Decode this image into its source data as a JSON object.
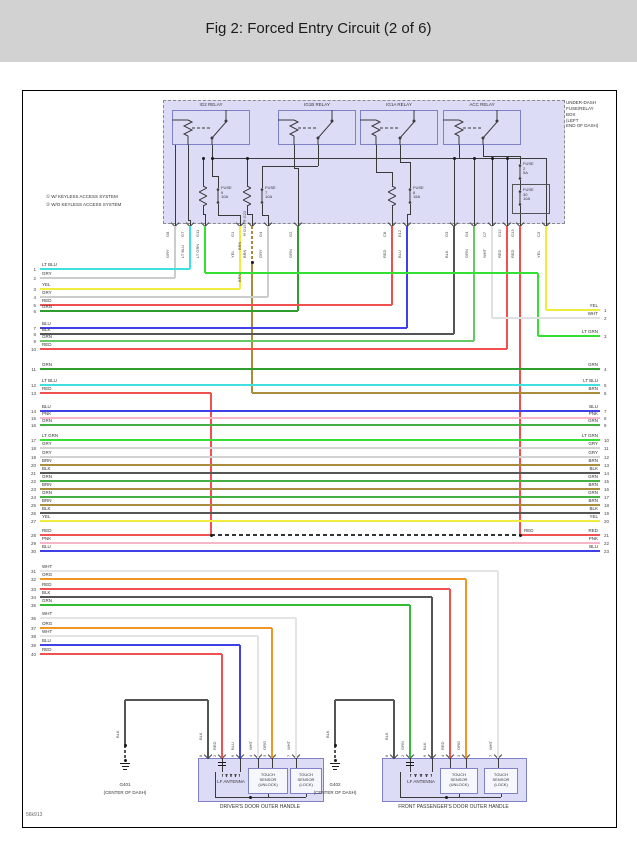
{
  "title": "Fig 2: Forced Entry Circuit (2 of 6)",
  "footer_id": "56k913",
  "palette": {
    "header": "#d2d2d2",
    "box_fill": "#dcdcf7",
    "box_border": "#8a8a8a",
    "line": "#3a3a3a"
  },
  "box_label_lines": [
    "UNDER-DASH",
    "FUSE/RELAY",
    "BOX",
    "(LEFT",
    "END OF DASH)"
  ],
  "notes": [
    "① W/ KEYLESS ACCESS SYSTEM",
    "② W/O KEYLESS ACCESS SYSTEM"
  ],
  "relays": [
    {
      "label": "IG2 RELAY",
      "x": 172
    },
    {
      "label": "IG1B RELAY",
      "x": 278
    },
    {
      "label": "IG1A RELAY",
      "x": 360
    },
    {
      "label": "ACC RELAY",
      "x": 443
    }
  ],
  "fuses": [
    {
      "x": 218,
      "y": 188,
      "lines": [
        "FUSE",
        "9",
        "10A"
      ],
      "res_x": 203
    },
    {
      "x": 262,
      "y": 188,
      "lines": [
        "FUSE",
        "7",
        "10A"
      ],
      "res_x": 247
    },
    {
      "x": 410,
      "y": 188,
      "lines": [
        "FUSE",
        "8",
        "15A"
      ],
      "res_x": 392
    },
    {
      "x": 520,
      "y": 164,
      "lines": [
        "FUSE",
        "2",
        "5A"
      ]
    },
    {
      "x": 520,
      "y": 190,
      "lines": [
        "FUSE",
        "30",
        "10A"
      ],
      "boxed": true
    }
  ],
  "fuse30_box": [
    512,
    184,
    36,
    28
  ],
  "top_pins": [
    {
      "x": 175,
      "id": "G8",
      "c": "GRY"
    },
    {
      "x": 190,
      "id": "G7",
      "c": "LT BLU"
    },
    {
      "x": 205,
      "id": "G11",
      "c": "LT GRN"
    },
    {
      "x": 240,
      "id": "G1",
      "c": "YEL"
    },
    {
      "x": 252,
      "id": "①G15 ②G22",
      "c": "BRN"
    },
    {
      "x": 268,
      "id": "G4",
      "c": "GRY"
    },
    {
      "x": 298,
      "id": "G2",
      "c": "GRN"
    },
    {
      "x": 392,
      "id": "C8",
      "c": "RED"
    },
    {
      "x": 407,
      "id": "E12",
      "c": "BLU"
    },
    {
      "x": 454,
      "id": "G3",
      "c": "BLK"
    },
    {
      "x": 474,
      "id": "G4",
      "c": "GRN"
    },
    {
      "x": 492,
      "id": "C7",
      "c": "WHT"
    },
    {
      "x": 507,
      "id": "G12",
      "c": "RED"
    },
    {
      "x": 520,
      "id": "G13",
      "c": "RED"
    },
    {
      "x": 546,
      "id": "C3",
      "c": "YEL"
    }
  ],
  "left_rows": [
    {
      "n": 1,
      "c": "LT BLU",
      "y": 269,
      "x1": 40,
      "x2": 190,
      "hex": "#40e0e0"
    },
    {
      "n": 2,
      "c": "GRY",
      "y": 278,
      "x1": 40,
      "x2": 175,
      "hex": "#cccccc"
    },
    {
      "n": 3,
      "c": "YEL",
      "y": 289,
      "x1": 40,
      "x2": 240,
      "hex": "#f0ec3e"
    },
    {
      "n": 4,
      "c": "GRY",
      "y": 297,
      "x1": 40,
      "x2": 268,
      "hex": "#cccccc"
    },
    {
      "n": 5,
      "c": "RED",
      "y": 305,
      "x1": 40,
      "x2": 392,
      "hex": "#f05050"
    },
    {
      "n": 6,
      "c": "GRN",
      "y": 311,
      "x1": 40,
      "x2": 298,
      "hex": "#2f9e2f"
    },
    {
      "n": 7,
      "c": "BLU",
      "y": 328,
      "x1": 40,
      "x2": 407,
      "hex": "#4040e8"
    },
    {
      "n": 8,
      "c": "BLK",
      "y": 334,
      "x1": 40,
      "x2": 454,
      "hex": "#555555"
    },
    {
      "n": 9,
      "c": "GRN",
      "y": 341,
      "x1": 40,
      "x2": 474,
      "hex": "#66c966"
    },
    {
      "n": 10,
      "c": "RED",
      "y": 349,
      "x1": 40,
      "x2": 507,
      "hex": "#f05050"
    },
    {
      "n": 11,
      "c": "GRN",
      "y": 369,
      "x1": 40,
      "x2": 600,
      "hex": "#2f9e2f",
      "rn": 4,
      "rc": "GRN"
    },
    {
      "n": 12,
      "c": "LT BLU",
      "y": 385,
      "x1": 40,
      "x2": 600,
      "hex": "#40e0e0",
      "rn": 5,
      "rc": "LT BLU"
    },
    {
      "n": 13,
      "c": "RED",
      "y": 393,
      "x1": 40,
      "x2": 211,
      "hex": "#f05050",
      "rn": 6,
      "rc": "BRN"
    },
    {
      "n": 14,
      "c": "BLU",
      "y": 411,
      "x1": 40,
      "x2": 600,
      "hex": "#4040e8",
      "rn": 7,
      "rc": "BLU"
    },
    {
      "n": 15,
      "c": "PNK",
      "y": 418,
      "x1": 40,
      "x2": 600,
      "hex": "#f7b6c8",
      "rn": 8,
      "rc": "PNK"
    },
    {
      "n": 16,
      "c": "GRN",
      "y": 425,
      "x1": 40,
      "x2": 600,
      "hex": "#44b044",
      "rn": 9,
      "rc": "GRN"
    },
    {
      "n": 17,
      "c": "LT GRN",
      "y": 440,
      "x1": 40,
      "x2": 600,
      "hex": "#35e035",
      "rn": 10,
      "rc": "LT GRN"
    },
    {
      "n": 18,
      "c": "GRY",
      "y": 448,
      "x1": 40,
      "x2": 600,
      "hex": "#d2d2d2",
      "rn": 11,
      "rc": "GRY"
    },
    {
      "n": 19,
      "c": "GRY",
      "y": 457,
      "x1": 40,
      "x2": 600,
      "hex": "#d2d2d2",
      "rn": 12,
      "rc": "GRY"
    },
    {
      "n": 20,
      "c": "BRN",
      "y": 465,
      "x1": 40,
      "x2": 600,
      "hex": "#ab8b3c",
      "rn": 13,
      "rc": "BRN"
    },
    {
      "n": 21,
      "c": "BLK",
      "y": 473,
      "x1": 40,
      "x2": 600,
      "hex": "#555555",
      "rn": 14,
      "rc": "BLK"
    },
    {
      "n": 22,
      "c": "GRN",
      "y": 481,
      "x1": 40,
      "x2": 600,
      "hex": "#44b044",
      "rn": 15,
      "rc": "GRN"
    },
    {
      "n": 23,
      "c": "BRN",
      "y": 489,
      "x1": 40,
      "x2": 600,
      "hex": "#ab8b3c",
      "rn": 16,
      "rc": "BRN"
    },
    {
      "n": 24,
      "c": "GRN",
      "y": 497,
      "x1": 40,
      "x2": 600,
      "hex": "#44b044",
      "rn": 17,
      "rc": "GRN"
    },
    {
      "n": 25,
      "c": "BRN",
      "y": 505,
      "x1": 40,
      "x2": 600,
      "hex": "#ab8b3c",
      "rn": 18,
      "rc": "BRN"
    },
    {
      "n": 26,
      "c": "BLK",
      "y": 513,
      "x1": 40,
      "x2": 600,
      "hex": "#555555",
      "rn": 19,
      "rc": "BLK"
    },
    {
      "n": 27,
      "c": "YEL",
      "y": 521,
      "x1": 40,
      "x2": 600,
      "hex": "#f0ec3e",
      "rn": 20,
      "rc": "YEL"
    },
    {
      "n": 28,
      "c": "RED",
      "y": 535,
      "x1": 40,
      "x2": 211,
      "hex": "#f05050",
      "rn": 21,
      "rc": "RED"
    },
    {
      "n": 29,
      "c": "PNK",
      "y": 543,
      "x1": 40,
      "x2": 600,
      "hex": "#f7b6c8",
      "rn": 22,
      "rc": "PNK"
    },
    {
      "n": 30,
      "c": "BLU",
      "y": 551,
      "x1": 40,
      "x2": 600,
      "hex": "#4040e8",
      "rn": 23,
      "rc": "BLU"
    },
    {
      "n": 31,
      "c": "WHT",
      "y": 571,
      "x1": 40,
      "x2": 498,
      "hex": "#e4e4e4"
    },
    {
      "n": 32,
      "c": "ORG",
      "y": 579,
      "x1": 40,
      "x2": 466,
      "hex": "#f09622"
    },
    {
      "n": 33,
      "c": "RED",
      "y": 589,
      "x1": 40,
      "x2": 450,
      "hex": "#f05050"
    },
    {
      "n": 34,
      "c": "BLK",
      "y": 597,
      "x1": 40,
      "x2": 432,
      "hex": "#555555"
    },
    {
      "n": 35,
      "c": "GRN",
      "y": 605,
      "x1": 40,
      "x2": 410,
      "hex": "#33bb33"
    },
    {
      "n": 36,
      "c": "WHT",
      "y": 618,
      "x1": 40,
      "x2": 296,
      "hex": "#e4e4e4"
    },
    {
      "n": 37,
      "c": "ORG",
      "y": 628,
      "x1": 40,
      "x2": 272,
      "hex": "#f09622"
    },
    {
      "n": 38,
      "c": "WHT",
      "y": 636,
      "x1": 40,
      "x2": 258,
      "hex": "#e4e4e4"
    },
    {
      "n": 39,
      "c": "BLU",
      "y": 645,
      "x1": 40,
      "x2": 240,
      "hex": "#4040e8",
      "w": 2
    },
    {
      "n": 40,
      "c": "RED",
      "y": 654,
      "x1": 40,
      "x2": 222,
      "hex": "#f05050",
      "w": 2
    }
  ],
  "right_stub_rows": [
    {
      "n": 1,
      "c": "YEL",
      "y": 310,
      "x1": 546,
      "hex": "#f0ec3e"
    },
    {
      "n": 2,
      "c": "WHT",
      "y": 318,
      "x1": 492,
      "hex": "#e0e0e0"
    },
    {
      "n": 3,
      "c": "LT GRN",
      "y": 336,
      "x1": 538,
      "hex": "#35e035"
    }
  ],
  "mid_labels": [
    {
      "t": "RED",
      "x": 524,
      "y": 528
    }
  ],
  "verticals": [
    {
      "x": 175,
      "y1": 226,
      "y2": 278,
      "hex": "#cccccc"
    },
    {
      "x": 190,
      "y1": 226,
      "y2": 269,
      "hex": "#40e0e0"
    },
    {
      "x": 205,
      "y1": 226,
      "y2": 273,
      "hex": "#35e035"
    },
    {
      "x": 240,
      "y1": 226,
      "y2": 289,
      "hex": "#f0ec3e"
    },
    {
      "x": 252,
      "y1": 226,
      "y2": 262,
      "hex": "#ab8b3c",
      "dashed": true
    },
    {
      "x": 252,
      "y1": 262,
      "y2": 393,
      "hex": "#ab8b3c"
    },
    {
      "x": 268,
      "y1": 226,
      "y2": 297,
      "hex": "#cccccc"
    },
    {
      "x": 298,
      "y1": 226,
      "y2": 311,
      "hex": "#2f9e2f"
    },
    {
      "x": 392,
      "y1": 226,
      "y2": 305,
      "hex": "#f05050"
    },
    {
      "x": 407,
      "y1": 226,
      "y2": 328,
      "hex": "#4040e8"
    },
    {
      "x": 454,
      "y1": 226,
      "y2": 334,
      "hex": "#555555"
    },
    {
      "x": 474,
      "y1": 226,
      "y2": 341,
      "hex": "#66c966"
    },
    {
      "x": 492,
      "y1": 226,
      "y2": 318,
      "hex": "#e0e0e0"
    },
    {
      "x": 507,
      "y1": 226,
      "y2": 349,
      "hex": "#f05050"
    },
    {
      "x": 520,
      "y1": 226,
      "y2": 535,
      "hex": "#f05050"
    },
    {
      "x": 546,
      "y1": 226,
      "y2": 310,
      "hex": "#f0ec3e"
    },
    {
      "x": 538,
      "y1": 273,
      "y2": 336,
      "hex": "#35e035"
    },
    {
      "x": 211,
      "y1": 393,
      "y2": 535,
      "hex": "#f05050"
    }
  ],
  "extra_segments": [
    {
      "x": 205,
      "y": 273,
      "len": 333,
      "o": "h",
      "hex": "#35e035"
    },
    {
      "x": 252,
      "y": 393,
      "len": 348,
      "o": "h",
      "hex": "#ab8b3c"
    },
    {
      "x": 520,
      "y": 535,
      "len": 80,
      "o": "h",
      "hex": "#f05050"
    },
    {
      "x": 211,
      "y": 535,
      "len": 309,
      "o": "h",
      "hex": "#333333",
      "dashed": true,
      "w": 1.6
    }
  ],
  "extra_vlabels": [
    {
      "x": 247,
      "y": 236,
      "h": 14,
      "t": "BRN"
    },
    {
      "x": 247,
      "y": 268,
      "h": 14,
      "t": "BRN"
    }
  ],
  "dots": [
    [
      252,
      262
    ],
    [
      211,
      535
    ],
    [
      520,
      535
    ],
    [
      203,
      158
    ],
    [
      212,
      158
    ],
    [
      247,
      158
    ],
    [
      454,
      158
    ],
    [
      474,
      158
    ],
    [
      492,
      158
    ],
    [
      507,
      158
    ]
  ],
  "interior": [
    [
      188,
      145,
      75,
      "v"
    ],
    [
      188,
      220,
      3,
      "h"
    ],
    [
      190,
      220,
      8,
      "v"
    ],
    [
      175,
      145,
      83,
      "v"
    ],
    [
      212,
      145,
      31,
      "v"
    ],
    [
      212,
      158,
      334,
      "h"
    ],
    [
      212,
      176,
      6,
      "h"
    ],
    [
      218,
      176,
      12,
      "v"
    ],
    [
      203,
      158,
      28,
      "v"
    ],
    [
      203,
      206,
      9,
      "v"
    ],
    [
      203,
      214,
      3,
      "h"
    ],
    [
      205,
      214,
      14,
      "v"
    ],
    [
      218,
      204,
      11,
      "v"
    ],
    [
      218,
      215,
      22,
      "h"
    ],
    [
      240,
      215,
      13,
      "v"
    ],
    [
      247,
      158,
      28,
      "v"
    ],
    [
      247,
      206,
      9,
      "v"
    ],
    [
      247,
      214,
      5,
      "h"
    ],
    [
      252,
      214,
      14,
      "v"
    ],
    [
      318,
      145,
      21,
      "v"
    ],
    [
      262,
      166,
      56,
      "h"
    ],
    [
      262,
      166,
      22,
      "v"
    ],
    [
      262,
      204,
      11,
      "v"
    ],
    [
      262,
      215,
      6,
      "h"
    ],
    [
      268,
      215,
      13,
      "v"
    ],
    [
      294,
      145,
      23,
      "v"
    ],
    [
      294,
      168,
      4,
      "h"
    ],
    [
      298,
      168,
      60,
      "v"
    ],
    [
      376,
      145,
      27,
      "v"
    ],
    [
      376,
      172,
      16,
      "h"
    ],
    [
      392,
      172,
      14,
      "v"
    ],
    [
      392,
      206,
      22,
      "v"
    ],
    [
      400,
      145,
      17,
      "v"
    ],
    [
      400,
      162,
      10,
      "h"
    ],
    [
      410,
      162,
      26,
      "v"
    ],
    [
      410,
      204,
      11,
      "v"
    ],
    [
      407,
      214,
      4,
      "h"
    ],
    [
      407,
      214,
      14,
      "v"
    ],
    [
      459,
      145,
      13,
      "v"
    ],
    [
      483,
      145,
      11,
      "v"
    ],
    [
      483,
      156,
      37,
      "h"
    ],
    [
      520,
      156,
      8,
      "v"
    ],
    [
      520,
      180,
      10,
      "v"
    ],
    [
      520,
      206,
      22,
      "v"
    ],
    [
      454,
      158,
      70,
      "v"
    ],
    [
      474,
      158,
      70,
      "v"
    ],
    [
      492,
      158,
      70,
      "v"
    ],
    [
      507,
      158,
      70,
      "v"
    ],
    [
      546,
      158,
      70,
      "v"
    ]
  ],
  "handles": [
    {
      "caption": "DRIVER'S DOOR OUTER HANDLE",
      "box": [
        198,
        758,
        124,
        42
      ],
      "ground_x": 125,
      "ground_label": "G401",
      "ground_sub": "(CENTER OF DASH)",
      "antenna_label": "LF ANTENNA",
      "ant_idx": [
        1,
        2
      ],
      "sensors": [
        {
          "box": [
            248,
            768,
            40,
            26
          ],
          "lines": [
            "TOUCH",
            "SENSOR",
            "(UNLOCK)"
          ]
        },
        {
          "box": [
            290,
            768,
            32,
            26
          ],
          "lines": [
            "TOUCH",
            "SENSOR",
            "(LOCK)"
          ]
        }
      ],
      "bus": [
        215,
        306
      ],
      "bus_dot": 250,
      "pins": [
        {
          "x": 208,
          "n": "8",
          "c": "BLK",
          "gnd": true
        },
        {
          "x": 222,
          "n": "2",
          "c": "RED",
          "hex": "#f05050",
          "row_y": 654,
          "w": 2
        },
        {
          "x": 240,
          "n": "6",
          "c": "BLU",
          "hex": "#4040e8",
          "row_y": 645,
          "w": 2
        },
        {
          "x": 258,
          "n": "4",
          "c": "WHT",
          "hex": "#e4e4e4",
          "row_y": 636
        },
        {
          "x": 272,
          "n": "3",
          "c": "ORG",
          "hex": "#f09622",
          "row_y": 628
        },
        {
          "x": 296,
          "n": "7",
          "c": "WHT",
          "hex": "#e4e4e4",
          "row_y": 618
        }
      ]
    },
    {
      "caption": "FRONT PASSENGER'S DOOR OUTER HANDLE",
      "box": [
        382,
        758,
        143,
        42
      ],
      "ground_x": 335,
      "ground_label": "G402",
      "ground_sub": "(CENTER OF DASH)",
      "antenna_label": "LF ANTENNA",
      "ant_idx": [
        1,
        2
      ],
      "sensors": [
        {
          "box": [
            440,
            768,
            38,
            26
          ],
          "lines": [
            "TOUCH",
            "SENSOR",
            "(UNLOCK)"
          ]
        },
        {
          "box": [
            484,
            768,
            34,
            26
          ],
          "lines": [
            "TOUCH",
            "SENSOR",
            "(LOCK)"
          ]
        }
      ],
      "bus": [
        400,
        501
      ],
      "bus_dot": 446,
      "pins": [
        {
          "x": 394,
          "n": "8",
          "c": "BLK",
          "gnd": true
        },
        {
          "x": 410,
          "n": "2",
          "c": "GRN",
          "hex": "#33bb33",
          "row_y": 605,
          "w": 2
        },
        {
          "x": 432,
          "n": "6",
          "c": "BLK",
          "hex": "#555555",
          "row_y": 597,
          "w": 2
        },
        {
          "x": 450,
          "n": "4",
          "c": "RED",
          "hex": "#f05050",
          "row_y": 589
        },
        {
          "x": 466,
          "n": "3",
          "c": "ORG",
          "hex": "#f09622",
          "row_y": 579
        },
        {
          "x": 498,
          "n": "7",
          "c": "WHT",
          "hex": "#e4e4e4",
          "row_y": 571
        }
      ]
    }
  ]
}
